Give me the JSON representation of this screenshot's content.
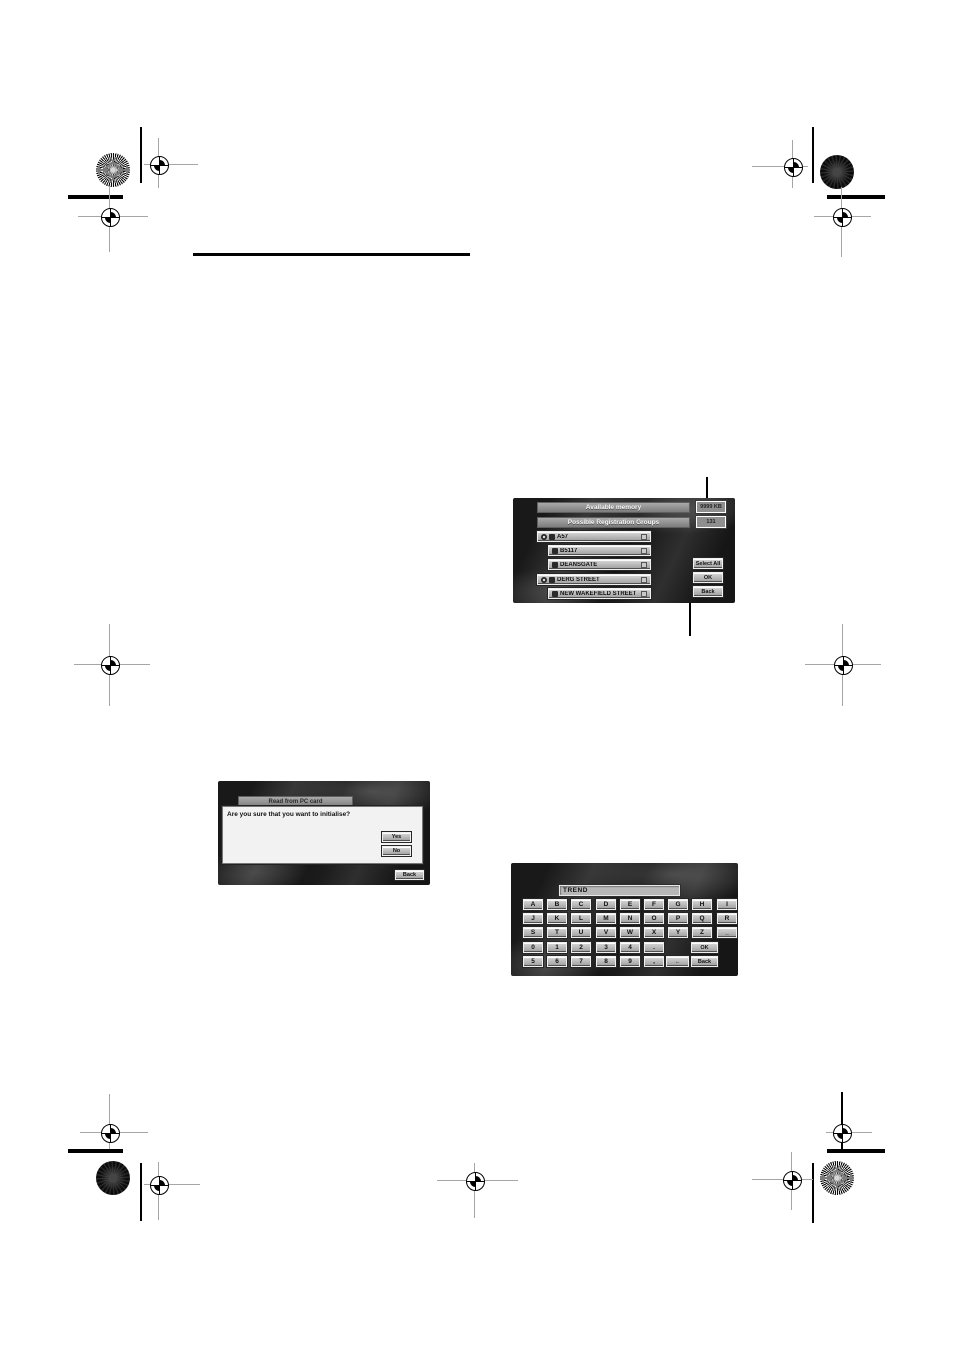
{
  "screen1": {
    "available_memory_label": "Available memory",
    "available_memory_value": "9999 KB",
    "groups_label": "Possible Registration Groups",
    "groups_value": "131",
    "items": [
      "A57",
      "B5117",
      "DEANSGATE",
      "DERG STREET",
      "NEW WAKEFIELD STREET"
    ],
    "select_all_label": "Select All",
    "ok_label": "OK",
    "back_label": "Back"
  },
  "screen2": {
    "title": "Read from PC card",
    "message": "Are you sure that you want to initialise?",
    "yes_label": "Yes",
    "no_label": "No",
    "back_label": "Back"
  },
  "screen3": {
    "input_value": "TREND",
    "keys_row1": [
      "A",
      "B",
      "C",
      "D",
      "E",
      "F",
      "G",
      "H",
      "I"
    ],
    "keys_row2": [
      "J",
      "K",
      "L",
      "M",
      "N",
      "O",
      "P",
      "Q",
      "R"
    ],
    "keys_row3": [
      "S",
      "T",
      "U",
      "V",
      "W",
      "X",
      "Y",
      "Z",
      "_"
    ],
    "keys_row4": [
      "0",
      "1",
      "2",
      "3",
      "4",
      "."
    ],
    "keys_row5": [
      "5",
      "6",
      "7",
      "8",
      "9",
      ","
    ],
    "backspace_label": "←",
    "ok_label": "OK",
    "back_label": "Back"
  },
  "colors": {
    "page_bg": "#ffffff",
    "screen_bg": "#1a1a1a",
    "button_face": "#b8b8b8",
    "bar_gray": "#8f8f8f",
    "dialog_bg": "#f2f2f2"
  }
}
